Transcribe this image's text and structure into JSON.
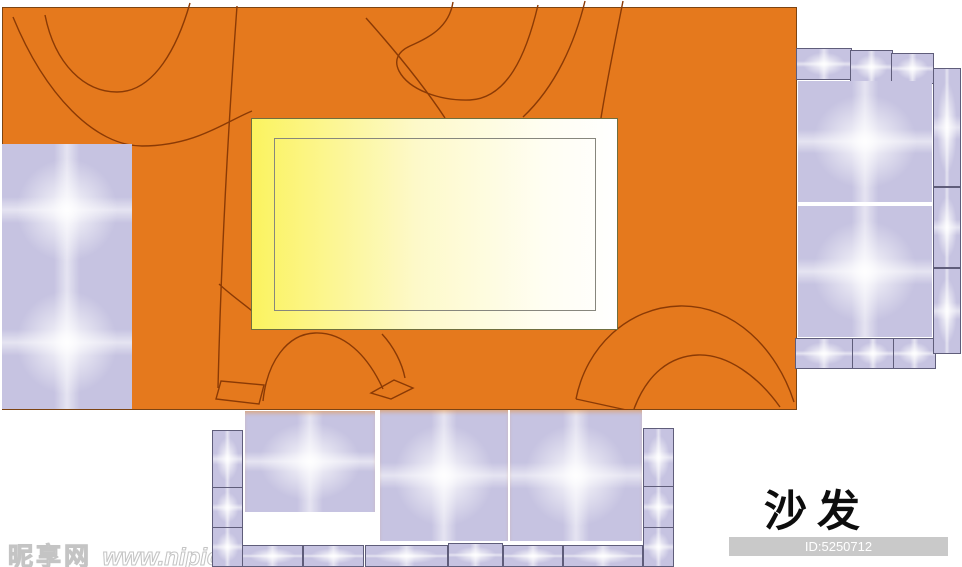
{
  "label": {
    "text": "沙发"
  },
  "watermark": {
    "site_name": "昵享网",
    "site_url": "www.nipic.cn"
  },
  "id_badge": {
    "text": "ID:5250712 NO:20100704203641009052"
  },
  "palette": {
    "rug_orange": "#e5791d",
    "rug_line": "#8b3a05",
    "rug_border": "#7c4413",
    "table_yellow": "#fbf35f",
    "table_white": "#ffffff",
    "table_border": "#6f6f3f",
    "cushion_lavender": "#c6c3e1",
    "cushion_border": "#5f5d7a",
    "label_color": "#0d0d0d",
    "id_badge_bg": "#c9c9c9",
    "id_badge_text": "#ffffff"
  }
}
